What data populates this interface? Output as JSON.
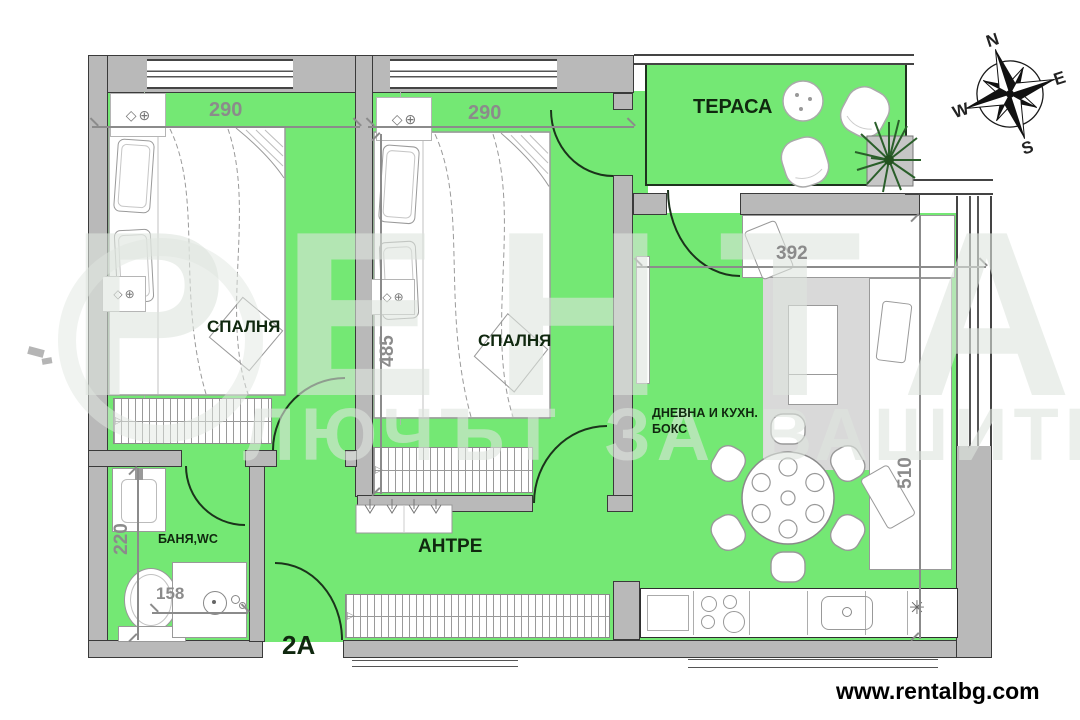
{
  "footer": {
    "url": "www.rentalbg.com"
  },
  "unit": {
    "number": "2А"
  },
  "compass": {
    "n": "N",
    "e": "E",
    "s": "S",
    "w": "W"
  },
  "watermark": {
    "brand": "РЕНТА",
    "tagline": "ЛЮЧЪТ ЗА ВАШИТЕ МЕЧ"
  },
  "rooms": {
    "bedroom1": {
      "label": "СПАЛНЯ",
      "width": "290"
    },
    "bedroom2": {
      "label": "СПАЛНЯ",
      "width": "290",
      "depth": "485"
    },
    "terrace": {
      "label": "ТЕРАСА"
    },
    "hallway": {
      "label": "АНТРЕ"
    },
    "bathroom": {
      "label": "БАНЯ,WC",
      "depth": "220",
      "shower_width": "158"
    },
    "living": {
      "label_line1": "ДНЕВНА И КУХН.",
      "label_line2": "БОКС",
      "width": "392",
      "depth": "510"
    }
  },
  "colors": {
    "room_fill": "#74e874",
    "wall_fill": "#b9b9b9",
    "dim_color": "#8b8b8b",
    "label_color": "#10280f",
    "plant_color": "#2a5f2a"
  }
}
